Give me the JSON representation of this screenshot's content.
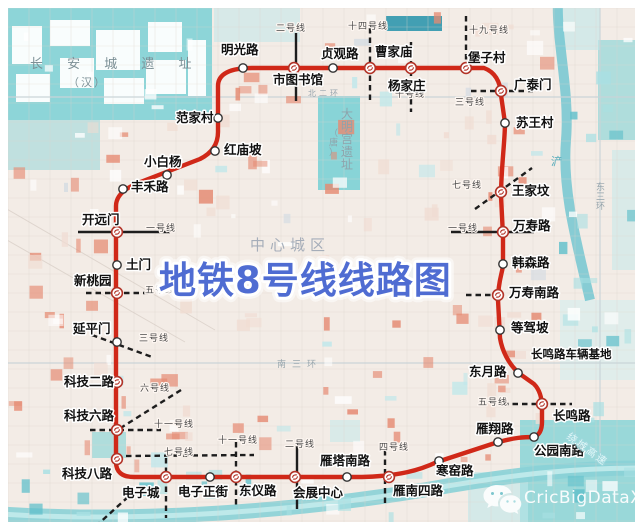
{
  "title": "地铁8号线线路图",
  "watermark": {
    "icon": "wechat-icon",
    "text": "CricBigDataXA"
  },
  "colors": {
    "line8": "#d02818",
    "crossing_line": "#1d1d1d",
    "title_blue": "#4f6cd2",
    "station_ring": "#333333",
    "interchange_ring": "#b23327",
    "station_label": "#111111",
    "line_label": "#4a4a4a",
    "water": "#82d3d6",
    "water_dark": "#2f97ad",
    "salmon_block": "#e58a72",
    "map_base": "#f3ece6"
  },
  "depot": {
    "name": "长鸣路车辆基地",
    "x": 531,
    "y": 358
  },
  "line8": {
    "name": "地铁8号线",
    "stations": [
      {
        "name": "明光路",
        "x": 243,
        "y": 68,
        "t": "r",
        "lx": 221,
        "ly": 54
      },
      {
        "name": "市图书馆",
        "x": 294,
        "y": 68,
        "t": "i",
        "lx": 273,
        "ly": 84
      },
      {
        "name": "贞观路",
        "x": 333,
        "y": 68,
        "t": "r",
        "lx": 321,
        "ly": 58
      },
      {
        "name": "曹家庙",
        "x": 370,
        "y": 68,
        "t": "i",
        "lx": 375,
        "ly": 56
      },
      {
        "name": "杨家庄",
        "x": 411,
        "y": 68,
        "t": "i",
        "lx": 388,
        "ly": 90
      },
      {
        "name": "堡子村",
        "x": 466,
        "y": 68,
        "t": "i",
        "lx": 468,
        "ly": 62
      },
      {
        "name": "广泰门",
        "x": 501,
        "y": 91,
        "t": "i",
        "lx": 514,
        "ly": 89
      },
      {
        "name": "苏王村",
        "x": 505,
        "y": 123,
        "t": "r",
        "lx": 516,
        "ly": 127
      },
      {
        "name": "王家坟",
        "x": 501,
        "y": 192,
        "t": "i",
        "lx": 512,
        "ly": 195
      },
      {
        "name": "万寿路",
        "x": 503,
        "y": 232,
        "t": "i",
        "lx": 513,
        "ly": 230
      },
      {
        "name": "韩森路",
        "x": 503,
        "y": 264,
        "t": "r",
        "lx": 512,
        "ly": 267
      },
      {
        "name": "万寿南路",
        "x": 498,
        "y": 295,
        "t": "i",
        "lx": 509,
        "ly": 297
      },
      {
        "name": "等驾坡",
        "x": 500,
        "y": 330,
        "t": "r",
        "lx": 511,
        "ly": 332
      },
      {
        "name": "东月路",
        "x": 518,
        "y": 373,
        "t": "r",
        "lx": 469,
        "ly": 376
      },
      {
        "name": "长鸣路",
        "x": 542,
        "y": 404,
        "t": "i",
        "lx": 553,
        "ly": 420
      },
      {
        "name": "公园南路",
        "x": 534,
        "y": 437,
        "t": "r",
        "lx": 534,
        "ly": 455
      },
      {
        "name": "雁翔路",
        "x": 498,
        "y": 442,
        "t": "r",
        "lx": 476,
        "ly": 433
      },
      {
        "name": "寒窑路",
        "x": 439,
        "y": 461,
        "t": "r",
        "lx": 436,
        "ly": 475
      },
      {
        "name": "雁南四路",
        "x": 389,
        "y": 477,
        "t": "i",
        "lx": 393,
        "ly": 495
      },
      {
        "name": "雁塔南路",
        "x": 347,
        "y": 477,
        "t": "r",
        "lx": 320,
        "ly": 465
      },
      {
        "name": "会展中心",
        "x": 295,
        "y": 477,
        "t": "i",
        "lx": 293,
        "ly": 497
      },
      {
        "name": "东仪路",
        "x": 236,
        "y": 477,
        "t": "i",
        "lx": 239,
        "ly": 495
      },
      {
        "name": "电子正街",
        "x": 210,
        "y": 477,
        "t": "r",
        "lx": 178,
        "ly": 496
      },
      {
        "name": "电子城",
        "x": 166,
        "y": 477,
        "t": "i",
        "lx": 122,
        "ly": 497
      },
      {
        "name": "科技八路",
        "x": 117,
        "y": 459,
        "t": "i",
        "lx": 62,
        "ly": 478
      },
      {
        "name": "科技六路",
        "x": 117,
        "y": 430,
        "t": "i",
        "lx": 64,
        "ly": 420
      },
      {
        "name": "科技二路",
        "x": 117,
        "y": 382,
        "t": "i",
        "lx": 64,
        "ly": 386
      },
      {
        "name": "延平门",
        "x": 117,
        "y": 342,
        "t": "r",
        "lx": 73,
        "ly": 333
      },
      {
        "name": "新桃园",
        "x": 117,
        "y": 293,
        "t": "i",
        "lx": 74,
        "ly": 285
      },
      {
        "name": "土门",
        "x": 117,
        "y": 265,
        "t": "r",
        "lx": 126,
        "ly": 269
      },
      {
        "name": "开远门",
        "x": 117,
        "y": 232,
        "t": "i",
        "lx": 82,
        "ly": 224
      },
      {
        "name": "丰禾路",
        "x": 123,
        "y": 189,
        "t": "r",
        "lx": 131,
        "ly": 191
      },
      {
        "name": "小白杨",
        "x": 167,
        "y": 175,
        "t": "r",
        "lx": 144,
        "ly": 166
      },
      {
        "name": "红庙坡",
        "x": 215,
        "y": 151,
        "t": "r",
        "lx": 224,
        "ly": 154
      },
      {
        "name": "范家村",
        "x": 218,
        "y": 118,
        "t": "r",
        "lx": 176,
        "ly": 122
      }
    ]
  },
  "other_lines": [
    {
      "name": "二号线",
      "style": "solid",
      "segs": [
        [
          296,
          33,
          296,
          101
        ]
      ],
      "label": [
        276,
        31
      ]
    },
    {
      "name": "二号线",
      "style": "solid",
      "segs": [
        [
          297,
          444,
          297,
          509
        ]
      ],
      "label": [
        285,
        447
      ]
    },
    {
      "name": "一号线",
      "style": "solid",
      "segs": [
        [
          78,
          232,
          170,
          232
        ]
      ],
      "label": [
        146,
        231
      ]
    },
    {
      "name": "一号线",
      "style": "solid",
      "segs": [
        [
          451,
          232,
          534,
          232
        ]
      ],
      "label": [
        448,
        231
      ]
    },
    {
      "name": "十四号线",
      "style": "dashed",
      "segs": [
        [
          370,
          28,
          370,
          104
        ]
      ],
      "label": [
        348,
        29
      ]
    },
    {
      "name": "十号线",
      "style": "dashed",
      "segs": [
        [
          411,
          42,
          411,
          112
        ]
      ],
      "label": [
        395,
        97
      ]
    },
    {
      "name": "十九号线",
      "style": "dashed",
      "segs": [
        [
          466,
          16,
          466,
          61
        ]
      ],
      "label": [
        469,
        33
      ]
    },
    {
      "name": "三号线",
      "style": "dashed",
      "segs": [
        [
          471,
          91,
          533,
          91
        ]
      ],
      "label": [
        455,
        105
      ]
    },
    {
      "name": "七号线",
      "style": "dashed",
      "segs": [
        [
          475,
          209,
          532,
          168
        ]
      ],
      "label": [
        452,
        188
      ]
    },
    {
      "name": "",
      "style": "dashed",
      "segs": [
        [
          466,
          295,
          492,
          295
        ]
      ],
      "label": null
    },
    {
      "name": "五号线",
      "style": "dashed",
      "segs": [
        [
          503,
          404,
          572,
          404
        ]
      ],
      "label": [
        478,
        405
      ]
    },
    {
      "name": "五号线",
      "style": "dashed",
      "segs": [
        [
          86,
          293,
          148,
          293
        ]
      ],
      "label": [
        145,
        293
      ]
    },
    {
      "name": "三号线",
      "style": "dashed",
      "segs": [
        [
          92,
          335,
          152,
          357
        ]
      ],
      "label": [
        139,
        341
      ]
    },
    {
      "name": "六号线",
      "style": "dashed",
      "segs": [
        [
          181,
          390,
          119,
          429
        ]
      ],
      "label": [
        140,
        391
      ]
    },
    {
      "name": "十一号线",
      "style": "dashed",
      "segs": [
        [
          90,
          430,
          161,
          430
        ]
      ],
      "label": [
        154,
        427
      ]
    },
    {
      "name": "七号线",
      "style": "dashed",
      "segs": [
        [
          126,
          456,
          254,
          455
        ]
      ],
      "label": [
        164,
        455
      ]
    },
    {
      "name": "",
      "style": "dashed",
      "segs": [
        [
          166,
          458,
          166,
          518
        ],
        [
          128,
          497,
          96,
          526
        ]
      ],
      "label": null
    },
    {
      "name": "十一号线",
      "style": "dashed",
      "segs": [
        [
          236,
          442,
          236,
          508
        ]
      ],
      "label": [
        218,
        443
      ]
    },
    {
      "name": "四号线",
      "style": "dashed",
      "segs": [
        [
          385,
          450,
          385,
          505
        ]
      ],
      "label": [
        379,
        450
      ]
    }
  ],
  "map_labels": [
    {
      "t": "长 安 城 遗 址",
      "x": 30,
      "y": 68,
      "c": "ruin"
    },
    {
      "t": "（汉）",
      "x": 68,
      "y": 86,
      "c": "ruin2"
    },
    {
      "t": "大明宫遗址",
      "x": 341,
      "y": 118,
      "c": "ruinv",
      "vertical": true
    },
    {
      "t": "（唐）",
      "x": 329,
      "y": 136,
      "c": "ruinv2",
      "vertical": true
    },
    {
      "t": "北二环",
      "x": 308,
      "y": 96,
      "c": "road"
    },
    {
      "t": "中心城区",
      "x": 250,
      "y": 250,
      "c": "dist"
    },
    {
      "t": "浐",
      "x": 551,
      "y": 165,
      "c": "river"
    },
    {
      "t": "东三环",
      "x": 596,
      "y": 190,
      "c": "roadv",
      "vertical": true
    },
    {
      "t": "南三环",
      "x": 277,
      "y": 367,
      "c": "road2"
    },
    {
      "t": "绕城高速",
      "x": 566,
      "y": 438,
      "c": "hwy",
      "rotate": 36
    }
  ]
}
